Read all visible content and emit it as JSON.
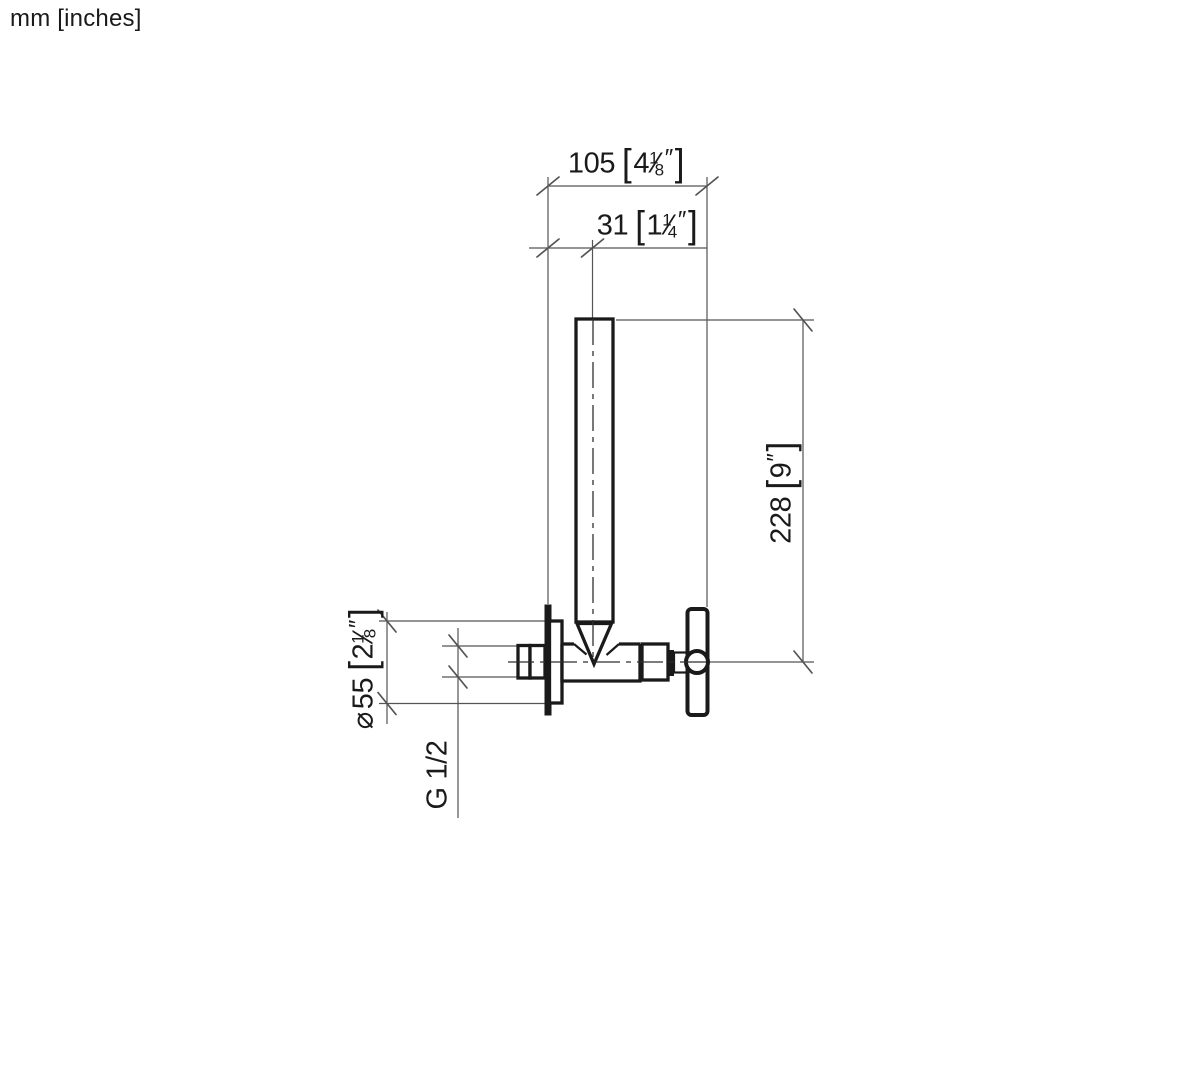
{
  "note": {
    "units": "mm [inches]"
  },
  "glyphs": {
    "bracket_open": "[",
    "bracket_close": "]",
    "fraction_slash": "⁄",
    "inch_mark": "″",
    "diameter_symbol": "⌀"
  },
  "dimensions": {
    "total_projection": {
      "mm": "105",
      "inch_whole": "4",
      "frac_num": "1",
      "frac_den": "8"
    },
    "outlet_offset": {
      "mm": "31",
      "inch_whole": "1",
      "frac_num": "1",
      "frac_den": "4"
    },
    "total_height": {
      "mm": "228",
      "inch_whole": "9"
    },
    "flange_diameter": {
      "mm": "55",
      "inch_whole": "2",
      "frac_num": "1",
      "frac_den": "8"
    },
    "thread_connection": {
      "label": "G 1/2"
    }
  },
  "colors": {
    "ink": "#1a1a1a",
    "dim_line": "#545454"
  }
}
